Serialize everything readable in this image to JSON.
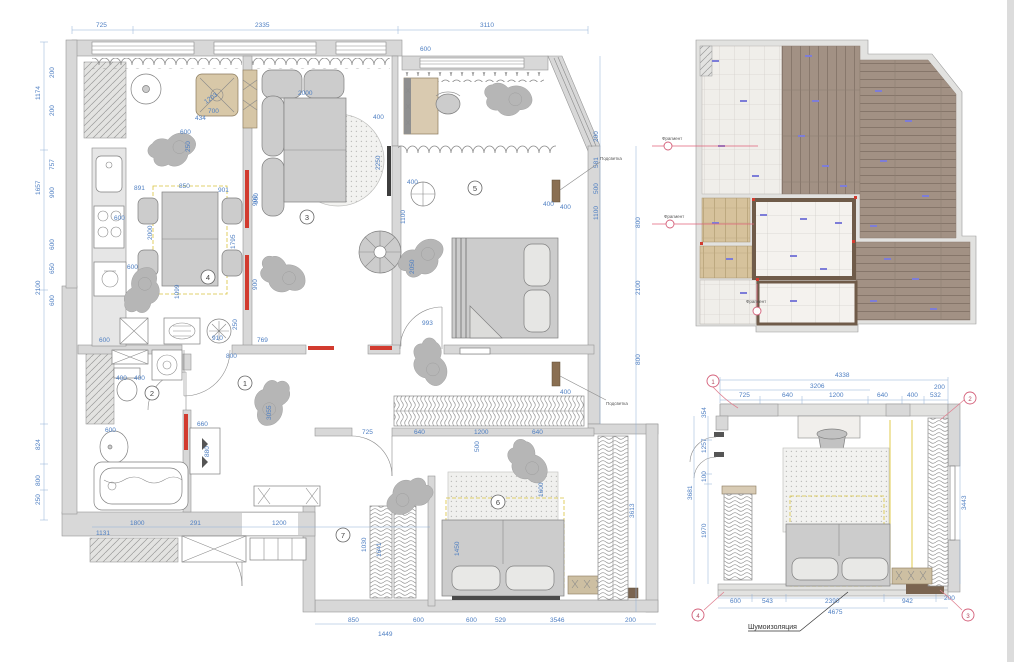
{
  "main": {
    "rooms": [
      "1",
      "2",
      "3",
      "4",
      "5",
      "6",
      "7"
    ],
    "top": [
      "725",
      "2335",
      "3110",
      "600"
    ],
    "left_outer": [
      "1174",
      "1657",
      "2100",
      "824",
      "800",
      "250"
    ],
    "left_inner": [
      "200",
      "200",
      "757",
      "900",
      "600",
      "650",
      "600"
    ],
    "bottom_inner": [
      "1800",
      "291",
      "1200",
      "1131"
    ],
    "bottom": [
      "850",
      "600",
      "1449",
      "600",
      "529",
      "3546",
      "200"
    ],
    "right_a": [
      "200",
      "581",
      "500",
      "1100",
      "400",
      "400"
    ],
    "right_b": [
      "800",
      "2100",
      "800",
      "3613"
    ],
    "kitchen": [
      "891",
      "850",
      "901",
      "2000",
      "600",
      "600",
      "1099",
      "1795",
      "900",
      "900",
      "250",
      "910",
      "769",
      "600"
    ],
    "living": [
      "1203",
      "434",
      "700",
      "600",
      "250",
      "2250",
      "400",
      "2000",
      "900"
    ],
    "bed5": [
      "400",
      "1100",
      "993",
      "400",
      "2050"
    ],
    "hall": [
      "800",
      "3055",
      "660",
      "880"
    ],
    "bath": [
      "400",
      "400",
      "600"
    ],
    "bed6": [
      "725",
      "640",
      "1200",
      "640",
      "500",
      "1600",
      "1450",
      "1030",
      "1641"
    ],
    "callout": "Подсветка"
  },
  "floor": {
    "marker_label": "Фрагмент"
  },
  "detail": {
    "total_top": "4338",
    "sub_top": "3206",
    "top": [
      "725",
      "640",
      "1200",
      "640",
      "400",
      "532",
      "200"
    ],
    "left": [
      "354",
      "1257",
      "100",
      "1970"
    ],
    "left_total": "3681",
    "right": "3443",
    "bottom": [
      "600",
      "543",
      "2390",
      "942",
      "200"
    ],
    "bottom_total": "4675",
    "markers": [
      "1",
      "2",
      "3",
      "4"
    ],
    "note": "Шумоизоляция"
  }
}
